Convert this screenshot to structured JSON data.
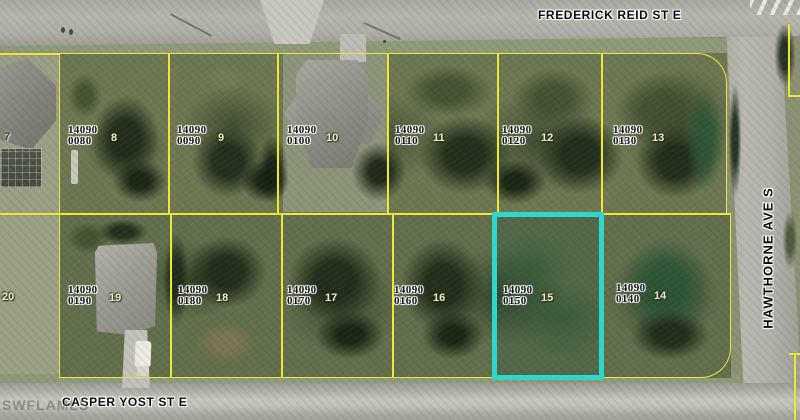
{
  "map": {
    "watermark": "SWFLAMLS",
    "streets": {
      "top": "FREDERICK REID ST E",
      "bottom": "CASPER YOST ST E",
      "right": "HAWTHORNE AVE S"
    },
    "colors": {
      "parcel_line": "#ede73d",
      "highlight_border": "#2fd6ce"
    },
    "highlighted_parcel": {
      "apn": "14090 0150",
      "lot": "15"
    },
    "parcels": [
      {
        "lot": "7"
      },
      {
        "lot": "8",
        "apn_line1": "14090",
        "apn_line2": "0080"
      },
      {
        "lot": "9",
        "apn_line1": "14090",
        "apn_line2": "0090"
      },
      {
        "lot": "10",
        "apn_line1": "14090",
        "apn_line2": "0100"
      },
      {
        "lot": "11",
        "apn_line1": "14090",
        "apn_line2": "0110"
      },
      {
        "lot": "12",
        "apn_line1": "14090",
        "apn_line2": "0120"
      },
      {
        "lot": "13",
        "apn_line1": "14090",
        "apn_line2": "0130"
      },
      {
        "lot": "14",
        "apn_line1": "14090",
        "apn_line2": "0140"
      },
      {
        "lot": "15",
        "apn_line1": "14090",
        "apn_line2": "0150",
        "highlighted": true
      },
      {
        "lot": "16",
        "apn_line1": "14090",
        "apn_line2": "0160"
      },
      {
        "lot": "17",
        "apn_line1": "14090",
        "apn_line2": "0170"
      },
      {
        "lot": "18",
        "apn_line1": "14090",
        "apn_line2": "0180"
      },
      {
        "lot": "19",
        "apn_line1": "14090",
        "apn_line2": "0190"
      },
      {
        "lot": "20"
      }
    ]
  }
}
